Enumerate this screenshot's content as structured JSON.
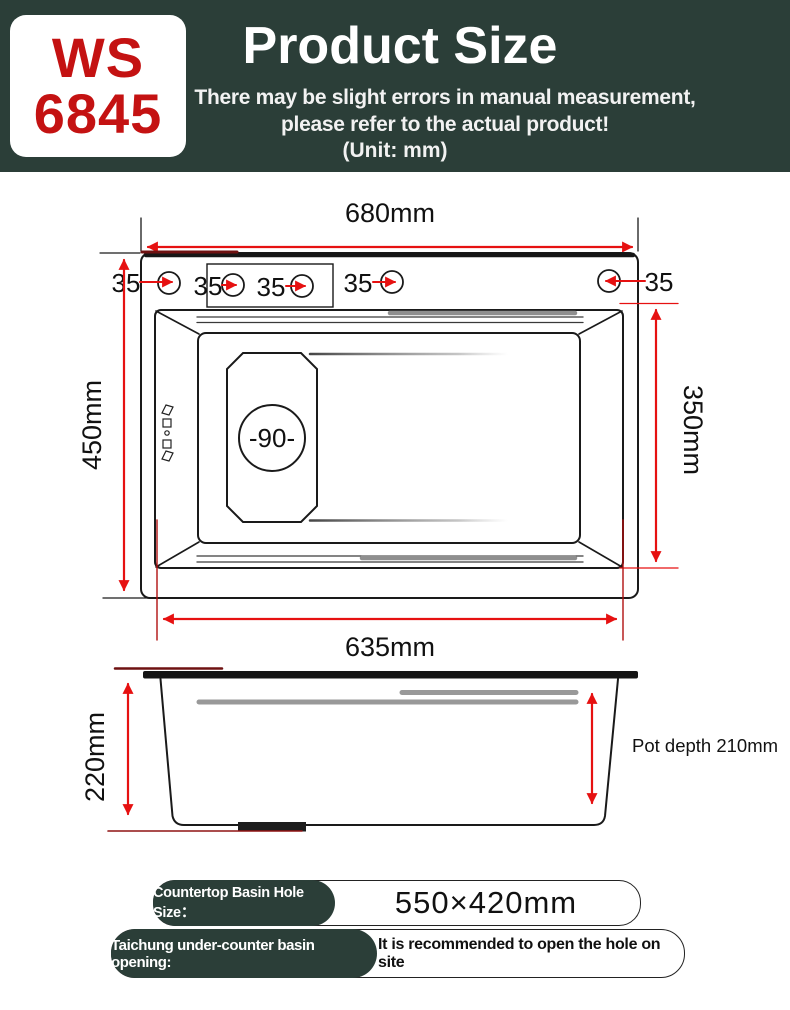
{
  "header": {
    "model_top": "WS",
    "model_bottom": "6845",
    "title": "Product Size",
    "subtitle1": "There may be slight errors in manual measurement,",
    "subtitle2": "please refer to the actual product!",
    "unit": "(Unit: mm)"
  },
  "top_view": {
    "total_width": "680mm",
    "total_depth": "450mm",
    "basin_depth": "350mm",
    "basin_width": "635mm",
    "holes": [
      "35",
      "35",
      "35",
      "35",
      "35"
    ],
    "drain": "-90-"
  },
  "side_view": {
    "height": "220mm",
    "pot_depth": "Pot depth 210mm"
  },
  "footer": {
    "hole_label": "Countertop Basin Hole Size：",
    "hole_value": "550×420mm",
    "opening_label": "Taichung under-counter basin opening:",
    "opening_value": "It is recommended to open the hole on site"
  },
  "colors": {
    "header_bg": "#2b3e38",
    "brand_red": "#c41212",
    "dimension_red": "#e61111",
    "dark_red": "#6e1111",
    "line_black": "#1a1a1a",
    "groove_gray": "#8f8f8f"
  }
}
